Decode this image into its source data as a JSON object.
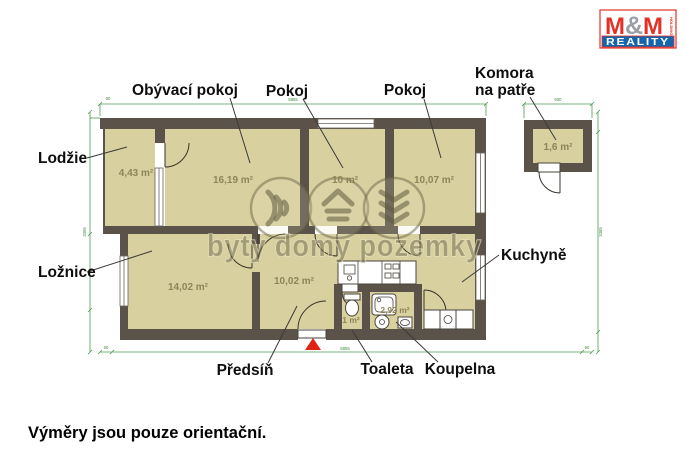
{
  "logo": {
    "m1": "M",
    "amp": "&",
    "m2": "M",
    "reality": "REALITY",
    "holding": "HOLDING"
  },
  "rooms": {
    "lodzie": {
      "label": "Lodžie",
      "area": "4,43 m²"
    },
    "obyvaci_pokoj": {
      "label": "Obývací pokoj",
      "area": "16,19 m²"
    },
    "pokoj_1": {
      "label": "Pokoj",
      "area": "10 m²"
    },
    "pokoj_2": {
      "label": "Pokoj",
      "area": "10,07 m²"
    },
    "komora": {
      "label_line1": "Komora",
      "label_line2": "na patře",
      "area": "1,6 m²"
    },
    "loznice": {
      "label": "Ložnice",
      "area": "14,02 m²"
    },
    "predsin": {
      "label": "Předsíň",
      "area": "10,02 m²"
    },
    "toaleta": {
      "label": "Toaleta",
      "area": "1 m²"
    },
    "koupelna": {
      "label": "Koupelna",
      "area": "2,92 m²"
    },
    "kuchyne": {
      "label": "Kuchyně"
    }
  },
  "watermark": {
    "text": "byty domy pozemky"
  },
  "dimensions": {
    "top": "5855",
    "komora_top": "600",
    "bottom": "5855",
    "left": "3365",
    "right": "3365",
    "stub": "60"
  },
  "footer": {
    "disclaimer": "Výměry jsou pouze orientační."
  },
  "colors": {
    "wall": "#5b5349",
    "floor": "#d8d09f",
    "dimension_green": "#3e8e41",
    "logo_red": "#e23128",
    "logo_blue": "#1565ad",
    "entrance_red": "#e02315"
  }
}
